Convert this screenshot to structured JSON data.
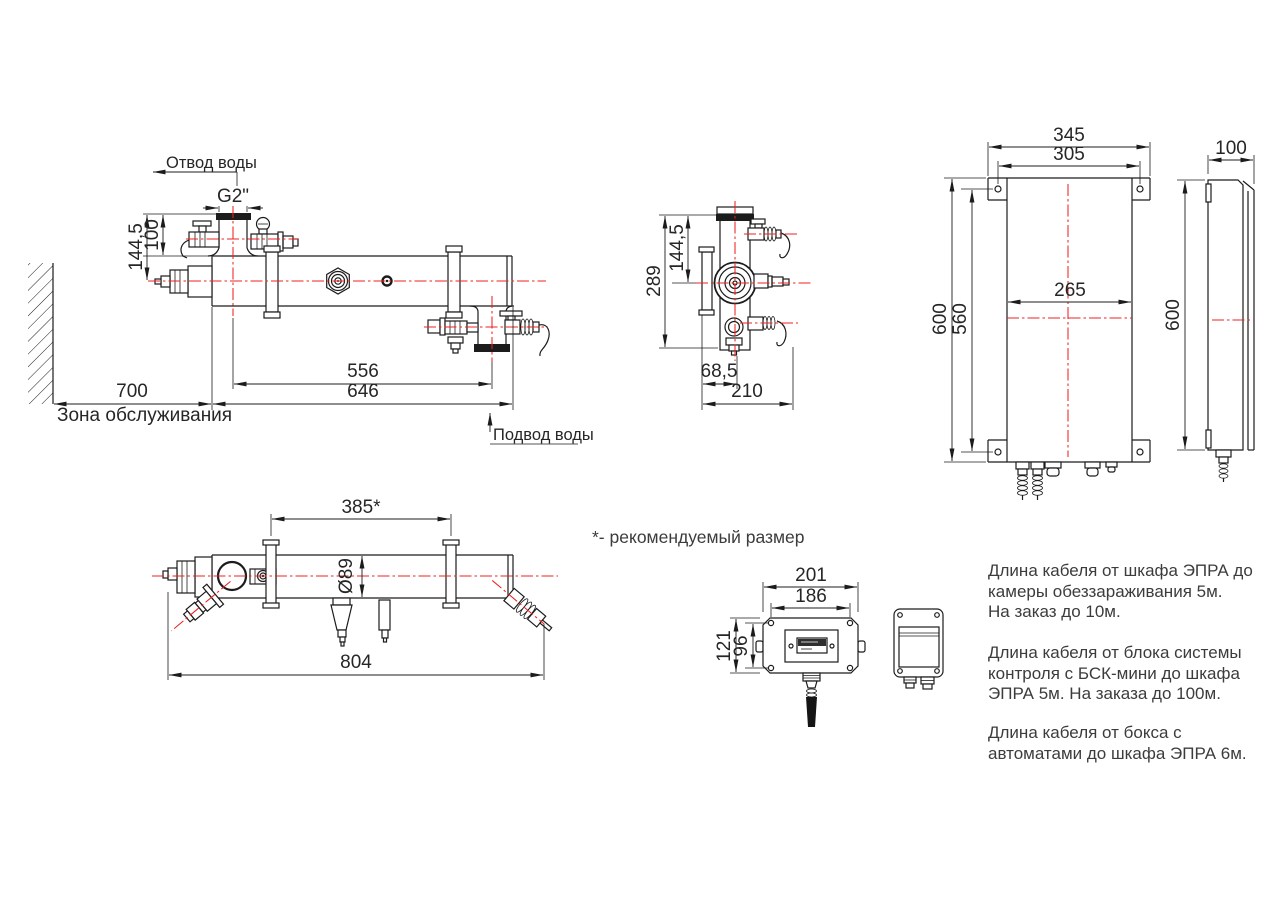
{
  "side_view": {
    "label_outlet": "Отвод воды",
    "label_inlet": "Подвод воды",
    "label_service_zone": "Зона обслуживания",
    "dim_thread": "G2\"",
    "dim_axis_height": "144,5",
    "dim_valve_height": "100",
    "dim_wall_offset": "700",
    "dim_ports_span": "556",
    "dim_body_length": "646"
  },
  "end_view": {
    "dim_height": "289",
    "dim_axis_height": "144,5",
    "dim_offset": "68,5",
    "dim_depth": "210"
  },
  "cabinet_front_view": {
    "dim_width": "345",
    "dim_mount_width": "305",
    "dim_inner_width": "265",
    "dim_height": "600",
    "dim_mount_height": "560"
  },
  "cabinet_side_view": {
    "dim_depth": "100",
    "dim_height": "600"
  },
  "top_view": {
    "dim_bracket_span": "385*",
    "dim_diameter": "Ø89",
    "dim_overall_length": "804"
  },
  "control_box_view": {
    "dim_width": "201",
    "dim_mount_width": "186",
    "dim_height": "121",
    "dim_mount_height": "96"
  },
  "footnote": "*- рекомендуемый размер",
  "notes": {
    "para1": {
      "line1": "Длина кабеля от шкафа ЭПРА до",
      "line2": "камеры обеззараживания 5м.",
      "line3": "На заказ до 10м."
    },
    "para2": {
      "line1": "Длина кабеля от блока системы",
      "line2": "контроля с БСК-мини до шкафа",
      "line3": "ЭПРА 5м. На заказа до 100м."
    },
    "para3": {
      "line1": "Длина кабеля от бокса с",
      "line2": "автоматами до шкафа ЭПРА 6м."
    }
  },
  "colors": {
    "line": "#1c1c1c",
    "centerline": "#ef2020",
    "text": "#262626",
    "notes_text": "#3c3c3c",
    "background": "#ffffff"
  }
}
